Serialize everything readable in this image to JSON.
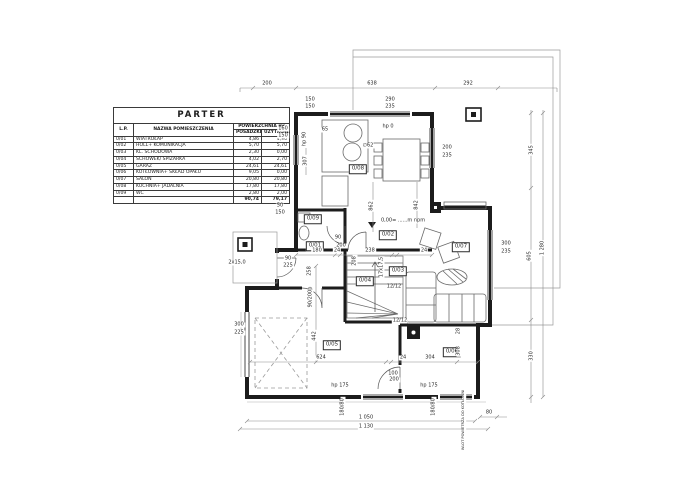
{
  "table": {
    "title": "PARTER",
    "col_lp": "L.P.",
    "col_name": "NAZWA POMIESZCZENIA",
    "col_area": "POWIERZCHNIA m²",
    "col_floor": "POSADZKI",
    "col_usable": "UŻYTKOWA",
    "rows": [
      {
        "lp": "0/01",
        "name": "WIATROŁAP",
        "floor": "4,86",
        "usable": "4,96"
      },
      {
        "lp": "0/02",
        "name": "HOLL+ KOMUNIKACJA",
        "floor": "5,70",
        "usable": "5,70"
      },
      {
        "lp": "0/03",
        "name": "KL. SCHODOWA",
        "floor": "2,30",
        "usable": "0,00"
      },
      {
        "lp": "0/04",
        "name": "SCHOWEK/ SPIŻARKA",
        "floor": "4,02",
        "usable": "2,70"
      },
      {
        "lp": "0/05",
        "name": "GARAŻ",
        "floor": "24,61",
        "usable": "24,61"
      },
      {
        "lp": "0/06",
        "name": "KOTŁOWNIA+ SKŁAD OPAŁU",
        "floor": "9,05",
        "usable": "0,00"
      },
      {
        "lp": "0/07",
        "name": "SALON",
        "floor": "20,80",
        "usable": "20,80"
      },
      {
        "lp": "0/08",
        "name": "KUCHNIA+ JADALNIA",
        "floor": "17,80",
        "usable": "17,80"
      },
      {
        "lp": "0/09",
        "name": "WC",
        "floor": "2,80",
        "usable": "2,00"
      }
    ],
    "total_floor": "90,74",
    "total_usable": "79,17"
  },
  "plan": {
    "labels": [
      {
        "text": "0/08",
        "x": 358,
        "y": 169,
        "boxed": true
      },
      {
        "text": "0/09",
        "x": 313,
        "y": 219,
        "boxed": true
      },
      {
        "text": "0/01",
        "x": 315,
        "y": 246,
        "boxed": true
      },
      {
        "text": "0/02",
        "x": 388,
        "y": 235,
        "boxed": true
      },
      {
        "text": "0/04",
        "x": 365,
        "y": 281,
        "boxed": true
      },
      {
        "text": "0/03",
        "x": 398,
        "y": 271,
        "boxed": true
      },
      {
        "text": "0/07",
        "x": 461,
        "y": 247,
        "boxed": true
      },
      {
        "text": "0/05",
        "x": 332,
        "y": 345,
        "boxed": true
      },
      {
        "text": "0/06",
        "x": 452,
        "y": 352,
        "boxed": true
      },
      {
        "text": "200",
        "x": 267,
        "y": 84
      },
      {
        "text": "638",
        "x": 372,
        "y": 84
      },
      {
        "text": "292",
        "x": 468,
        "y": 84
      },
      {
        "text": "1 050",
        "x": 366,
        "y": 418
      },
      {
        "text": "1 130",
        "x": 366,
        "y": 427
      },
      {
        "text": "80",
        "x": 489,
        "y": 413
      },
      {
        "text": "150",
        "x": 310,
        "y": 100
      },
      {
        "text": "150",
        "x": 310,
        "y": 107
      },
      {
        "text": "290",
        "x": 390,
        "y": 100
      },
      {
        "text": "235",
        "x": 390,
        "y": 107
      },
      {
        "text": "200",
        "x": 447,
        "y": 148
      },
      {
        "text": "235",
        "x": 447,
        "y": 156
      },
      {
        "text": "160",
        "x": 283,
        "y": 129
      },
      {
        "text": "150",
        "x": 283,
        "y": 136
      },
      {
        "text": "hp 0",
        "x": 388,
        "y": 127
      },
      {
        "text": "65",
        "x": 325,
        "y": 130
      },
      {
        "text": "∅62",
        "x": 368,
        "y": 146
      },
      {
        "text": "300",
        "x": 506,
        "y": 244
      },
      {
        "text": "235",
        "x": 506,
        "y": 252
      },
      {
        "text": "90",
        "x": 288,
        "y": 259
      },
      {
        "text": "225",
        "x": 288,
        "y": 266
      },
      {
        "text": "50",
        "x": 280,
        "y": 206
      },
      {
        "text": "150",
        "x": 280,
        "y": 213
      },
      {
        "text": "300",
        "x": 239,
        "y": 325
      },
      {
        "text": "225",
        "x": 239,
        "y": 333
      },
      {
        "text": "2x15,0",
        "x": 237,
        "y": 263
      },
      {
        "text": "90",
        "x": 338,
        "y": 238
      },
      {
        "text": "200",
        "x": 341,
        "y": 246
      },
      {
        "text": "180",
        "x": 317,
        "y": 251
      },
      {
        "text": "24",
        "x": 337,
        "y": 251
      },
      {
        "text": "238",
        "x": 370,
        "y": 251
      },
      {
        "text": "24",
        "x": 424,
        "y": 251
      },
      {
        "text": "624",
        "x": 321,
        "y": 358
      },
      {
        "text": "24",
        "x": 403,
        "y": 358
      },
      {
        "text": "304",
        "x": 430,
        "y": 358
      },
      {
        "text": "100",
        "x": 393,
        "y": 374
      },
      {
        "text": "200",
        "x": 393,
        "y": 382
      },
      {
        "text": "hp 175",
        "x": 340,
        "y": 386
      },
      {
        "text": "200",
        "x": 394,
        "y": 380
      },
      {
        "text": "hp 175",
        "x": 429,
        "y": 386
      },
      {
        "text": "12/12",
        "x": 394,
        "y": 287
      },
      {
        "text": "12/12",
        "x": 400,
        "y": 321
      },
      {
        "text": "0,00= ......m npm",
        "x": 403,
        "y": 221
      },
      {
        "text": "345",
        "x": 532,
        "y": 150,
        "rot": true
      },
      {
        "text": "605",
        "x": 530,
        "y": 256,
        "rot": true
      },
      {
        "text": "1 280",
        "x": 543,
        "y": 248,
        "rot": true
      },
      {
        "text": "330",
        "x": 532,
        "y": 356,
        "rot": true
      },
      {
        "text": "307",
        "x": 306,
        "y": 161,
        "rot": true
      },
      {
        "text": "258",
        "x": 310,
        "y": 271,
        "rot": true
      },
      {
        "text": "862",
        "x": 372,
        "y": 206,
        "rot": true
      },
      {
        "text": "842",
        "x": 417,
        "y": 205,
        "rot": true
      },
      {
        "text": "442",
        "x": 315,
        "y": 336,
        "rot": true
      },
      {
        "text": "208",
        "x": 355,
        "y": 261,
        "rot": true
      },
      {
        "text": "308",
        "x": 459,
        "y": 351,
        "rot": true
      },
      {
        "text": "28",
        "x": 459,
        "y": 331,
        "rot": true
      },
      {
        "text": "hp 90",
        "x": 305,
        "y": 139,
        "rot": true
      },
      {
        "text": "17x17,5",
        "x": 382,
        "y": 267,
        "rot": true
      },
      {
        "text": "90/200p",
        "x": 311,
        "y": 297,
        "rot": true
      },
      {
        "text": "180/80",
        "x": 343,
        "y": 407,
        "rot": true
      },
      {
        "text": "180/80",
        "x": 434,
        "y": 407,
        "rot": true
      },
      {
        "text": "WLOT POWIETRZA DO KOTŁOWNI",
        "x": 464,
        "y": 420,
        "rot": true,
        "size": 3.6
      }
    ]
  },
  "colors": {
    "wall": "#1c1c1c",
    "thin": "#8a8a8a",
    "furniture": "#6a6a6a",
    "background": "#ffffff"
  }
}
